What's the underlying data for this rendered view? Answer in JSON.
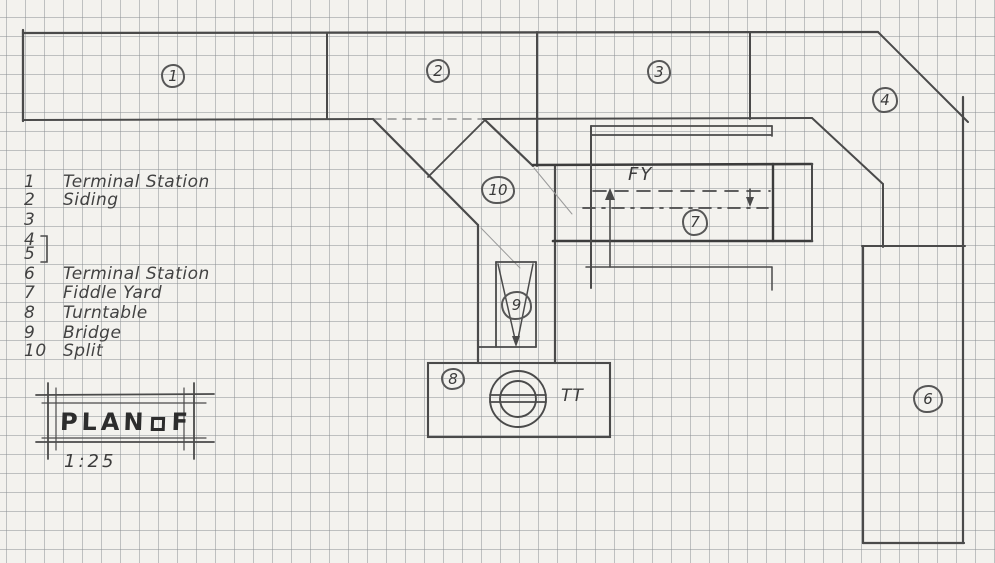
{
  "legend": {
    "items": [
      {
        "num": "1",
        "label": "Terminal Station"
      },
      {
        "num": "2",
        "label": "Siding"
      },
      {
        "num": "3",
        "label": ""
      },
      {
        "num": "4",
        "label": ""
      },
      {
        "num": "5",
        "label": ""
      },
      {
        "num": "6",
        "label": "Terminal Station"
      },
      {
        "num": "7",
        "label": "Fiddle Yard"
      },
      {
        "num": "8",
        "label": "Turntable"
      },
      {
        "num": "9",
        "label": "Bridge"
      },
      {
        "num": "10",
        "label": "Split"
      }
    ]
  },
  "plan": {
    "markers": [
      {
        "num": "1"
      },
      {
        "num": "2"
      },
      {
        "num": "3"
      },
      {
        "num": "4"
      },
      {
        "num": "6"
      },
      {
        "num": "7"
      },
      {
        "num": "8"
      },
      {
        "num": "9"
      },
      {
        "num": "10"
      }
    ],
    "labels": {
      "fiddle_yard": "FY",
      "turntable": "TT"
    }
  },
  "title_block": {
    "word": "PLAN",
    "letter": "F",
    "scale": "1:25"
  },
  "colors": {
    "pencil": "#4a4a4a",
    "pencil_bold": "#3c3c3c",
    "pencil_faint": "#9a9a9a",
    "paper": "#f3f2ee",
    "grid": "#8a8e92"
  }
}
